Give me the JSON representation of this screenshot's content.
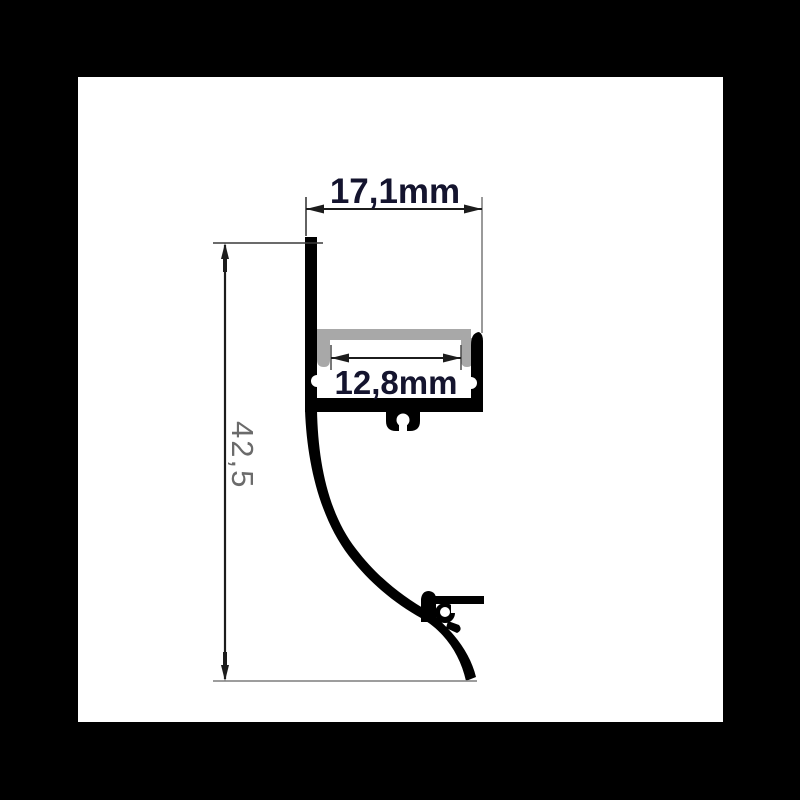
{
  "drawing": {
    "type": "technical-cross-section",
    "subject": "wall-mounted aluminium LED profile cross-section",
    "dimensions": {
      "width_top": {
        "label": "17,1mm"
      },
      "width_inner": {
        "label": "12,8mm"
      },
      "height": {
        "label": "42,5"
      }
    },
    "colors": {
      "background": "#000000",
      "canvas": "#ffffff",
      "profile": "#000000",
      "diffuser": "#a8a8a8",
      "dimension_text": "#14142e",
      "height_text": "#6b6b6b",
      "dim_line": "#1c1c1c",
      "ext_line_dark": "#3a3a3a",
      "ext_line_light": "#8f8f8f"
    }
  }
}
